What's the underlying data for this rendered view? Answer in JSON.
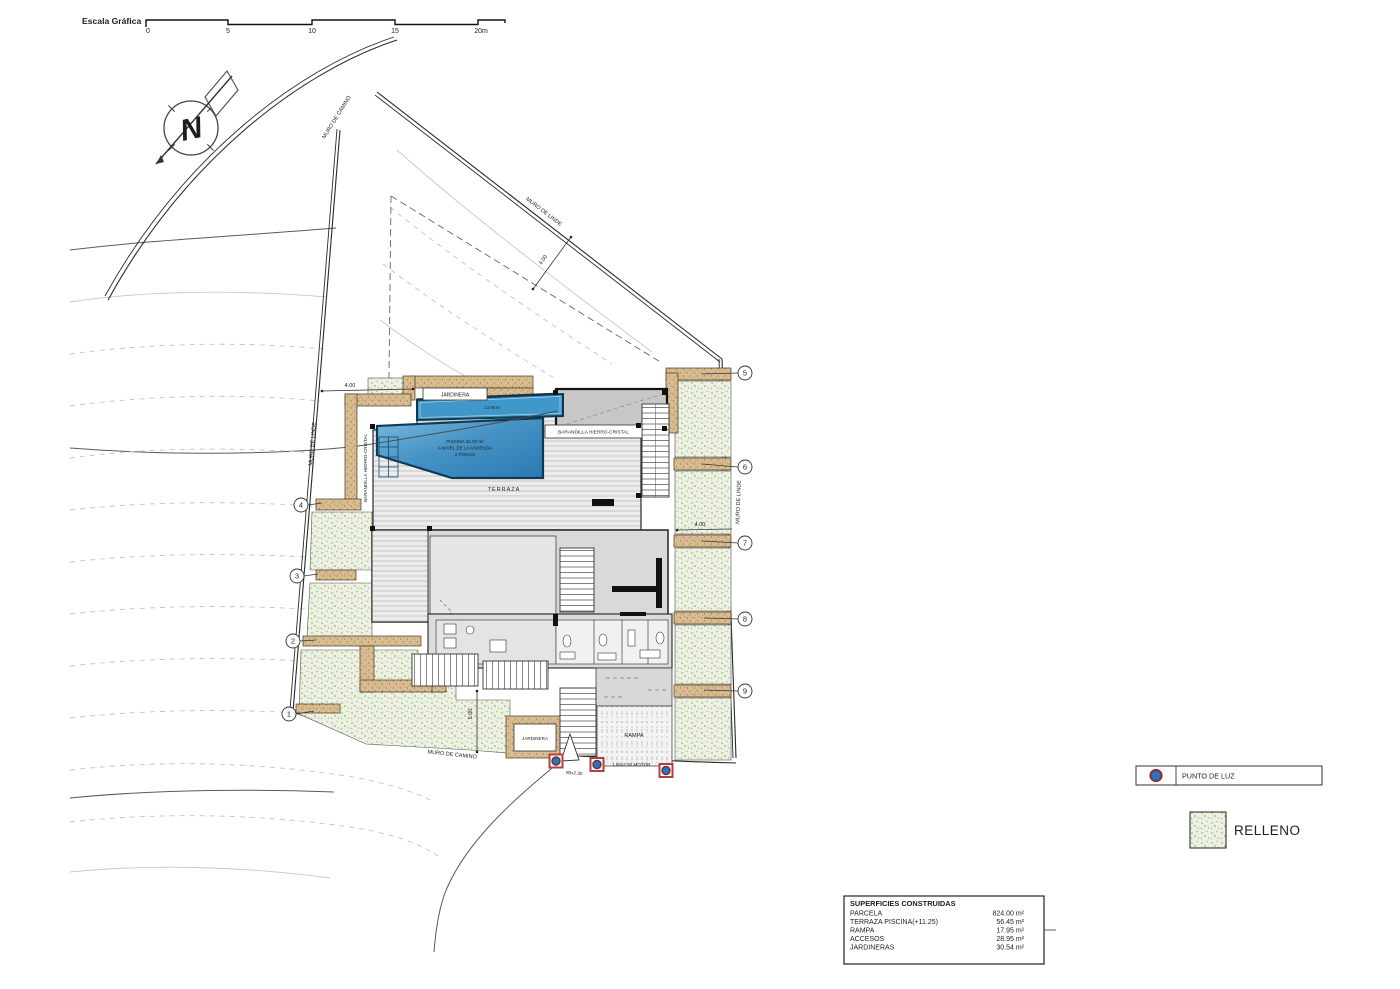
{
  "scale_bar": {
    "title": "Escala Gráfica",
    "ticks": [
      "0",
      "5",
      "10",
      "15",
      "20m"
    ]
  },
  "north_letter": "N",
  "walls": {
    "top_road": "MURO DE CAMINO",
    "top_linde": "MURO DE LINDE",
    "left_linde": "MURO DE LINDE",
    "right_linde": "MURO DE LINDE",
    "bottom_road": "MURO DE CAMINO"
  },
  "dims": {
    "d1": "4.00",
    "d2": "4.00",
    "d3": "4.00",
    "d4": "5.00"
  },
  "labels": {
    "jardinera_top": "JARDINERA",
    "jardinera_bottom": "JARDINERA",
    "terraza": "TERRAZA",
    "rampa": "RAMPA",
    "barandilla_left": "BARANDILLA HIERRO-CRISTAL",
    "barandilla_right": "BARANDILLA HIERRO-CRISTAL",
    "pool_area": "PISCINA 32.00 m²",
    "pool_level": "A NIVEL DE LA VIVIENDA",
    "pool_focos": "2 FOCOS",
    "pool_edge": "13.06 m",
    "gate_small": "80x2.30",
    "gate_motor": "1.80x3.50 MOTOR"
  },
  "markers": {
    "n1": "1",
    "n2": "2",
    "n3": "3",
    "n4": "4",
    "n5": "5",
    "n6": "6",
    "n7": "7",
    "n8": "8",
    "n9": "9"
  },
  "legend": {
    "punto_de_luz": "PUNTO DE LUZ",
    "relleno": "RELLENO"
  },
  "table": {
    "title": "SUPERFICIES CONSTRUIDAS",
    "rows": [
      {
        "label": "PARCELA",
        "value": "824.00 m²"
      },
      {
        "label": "TERRAZA PISCINA(+11.25)",
        "value": "56.45 m²"
      },
      {
        "label": "RAMPA",
        "value": "17.95 m²"
      },
      {
        "label": "ACCESOS",
        "value": "28.95 m²"
      },
      {
        "label": "JARDINERAS",
        "value": "30.54 m²"
      }
    ]
  },
  "colors": {
    "pool_deep": "#2a7ab3",
    "pool_light": "#7cb9de",
    "relleno_dot": "#9fb88c",
    "wall_tan": "#d9bd92",
    "marker_blue": "#2277c4",
    "marker_red": "#b04040"
  }
}
